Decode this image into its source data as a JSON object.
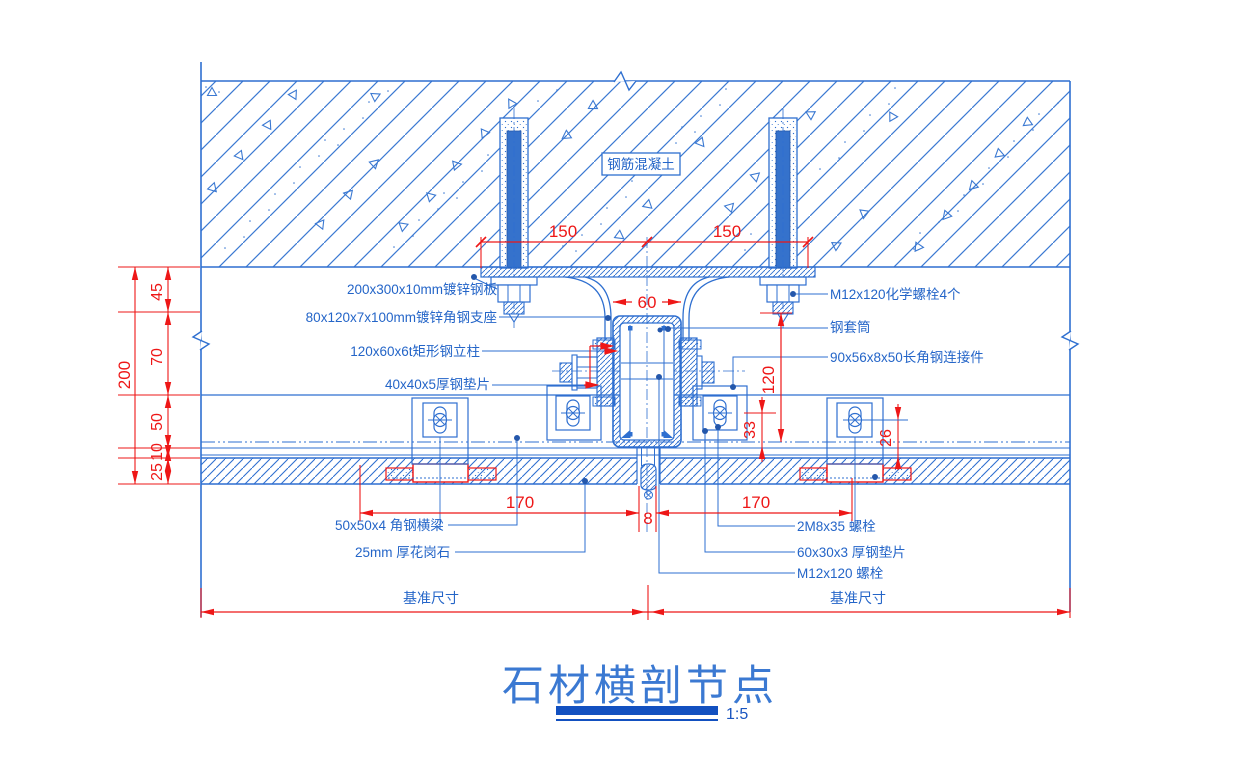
{
  "drawing": {
    "title": "石材横剖节点",
    "scale": "1:5",
    "colors": {
      "line_blue": "#2e6fd0",
      "dim_red": "#ee1717",
      "bar_blue": "#1250c0"
    }
  },
  "labels": {
    "concrete": "钢筋混凝土",
    "steel_plate": "200x300x10mm镀锌钢板",
    "angle_support": "80x120x7x100mm镀锌角钢支座",
    "steel_column": "120x60x6t矩形钢立柱",
    "washer_40": "40x40x5厚钢垫片",
    "angle_beam": "50x50x4 角钢横梁",
    "granite": "25mm 厚花岗石",
    "chem_bolt": "M12x120化学螺栓4个",
    "sleeve": "钢套筒",
    "angle_connector": "90x56x8x50长角钢连接件",
    "bolt_2m8": "2M8x35 螺栓",
    "washer_60": "60x30x3 厚钢垫片",
    "bolt_m12": "M12x120 螺栓"
  },
  "dims": {
    "d150a": "150",
    "d150b": "150",
    "d60": "60",
    "d200": "200",
    "d45": "45",
    "d70": "70",
    "d50": "50",
    "d10": "10",
    "d25": "25",
    "d120": "120",
    "d33": "33",
    "d26": "26",
    "d170a": "170",
    "d8": "8",
    "d170b": "170",
    "baseline_left": "基准尺寸",
    "baseline_right": "基准尺寸"
  }
}
